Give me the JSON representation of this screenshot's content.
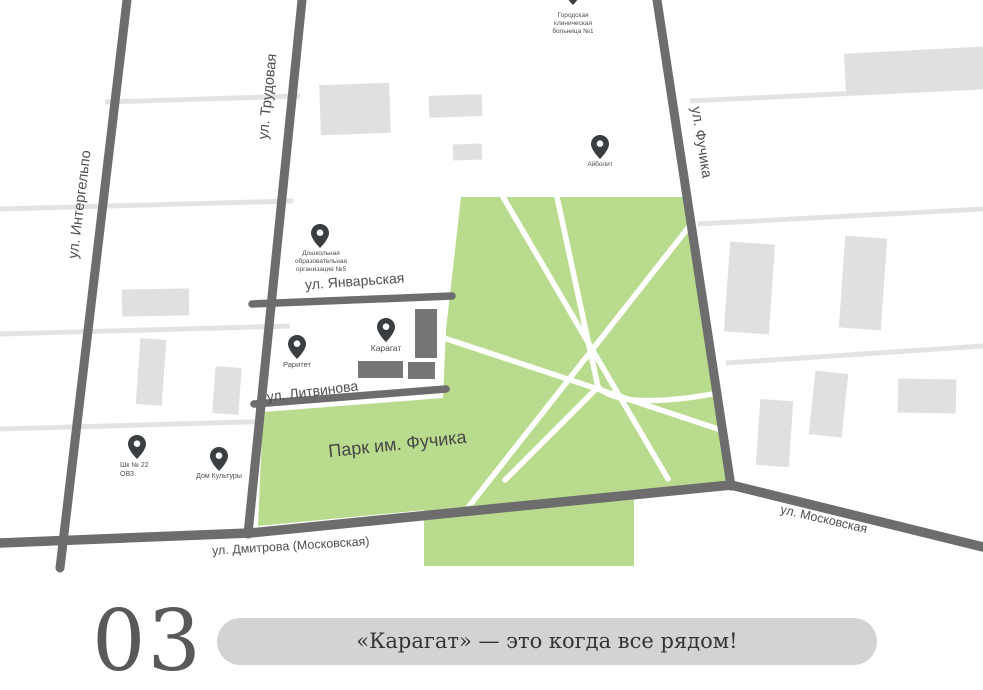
{
  "map": {
    "streets": {
      "intergelpo": "ул. Интергельпо",
      "trudovaya": "ул. Трудовая",
      "fuchika": "ул. Фучика",
      "yanvarskaya": "ул. Январьская",
      "litvinova": "ул. Литвинова",
      "dmitrova": "ул. Дмитрова (Московская)",
      "moskovskaya": "ул. Московская"
    },
    "park_label": "Парк им. Фучика",
    "pois": {
      "hospital": {
        "icon": "location-pin",
        "lines": [
          "Городская",
          "клиническая",
          "больница №1"
        ]
      },
      "aybolit": {
        "icon": "location-pin",
        "lines": [
          "Айболит"
        ]
      },
      "preschool": {
        "icon": "location-pin",
        "lines": [
          "Дошкольная",
          "образовательная",
          "организация №5"
        ]
      },
      "raritet": {
        "icon": "location-pin",
        "lines": [
          "Раритет"
        ]
      },
      "karagat": {
        "icon": "location-pin",
        "lines": [
          "Карагат"
        ]
      },
      "school22": {
        "icon": "location-pin",
        "lines": [
          "Шк № 22",
          "ОВЗ"
        ]
      },
      "dom_kultury": {
        "icon": "location-pin",
        "lines": [
          "Дом Культуры"
        ]
      }
    }
  },
  "footer": {
    "number": "03",
    "slogan": "«Карагат» — это когда все рядом!"
  },
  "colors": {
    "park_green": "#b9db8e",
    "road_major": "#6d6d6d",
    "road_minor": "#e3e3e3",
    "building_light": "#e0e0e0",
    "building_dark": "#767676",
    "pin": "#3a3e41",
    "label_text": "#4f4f4f",
    "pill_background": "#d2d3d4",
    "number_text": "#58595b"
  }
}
